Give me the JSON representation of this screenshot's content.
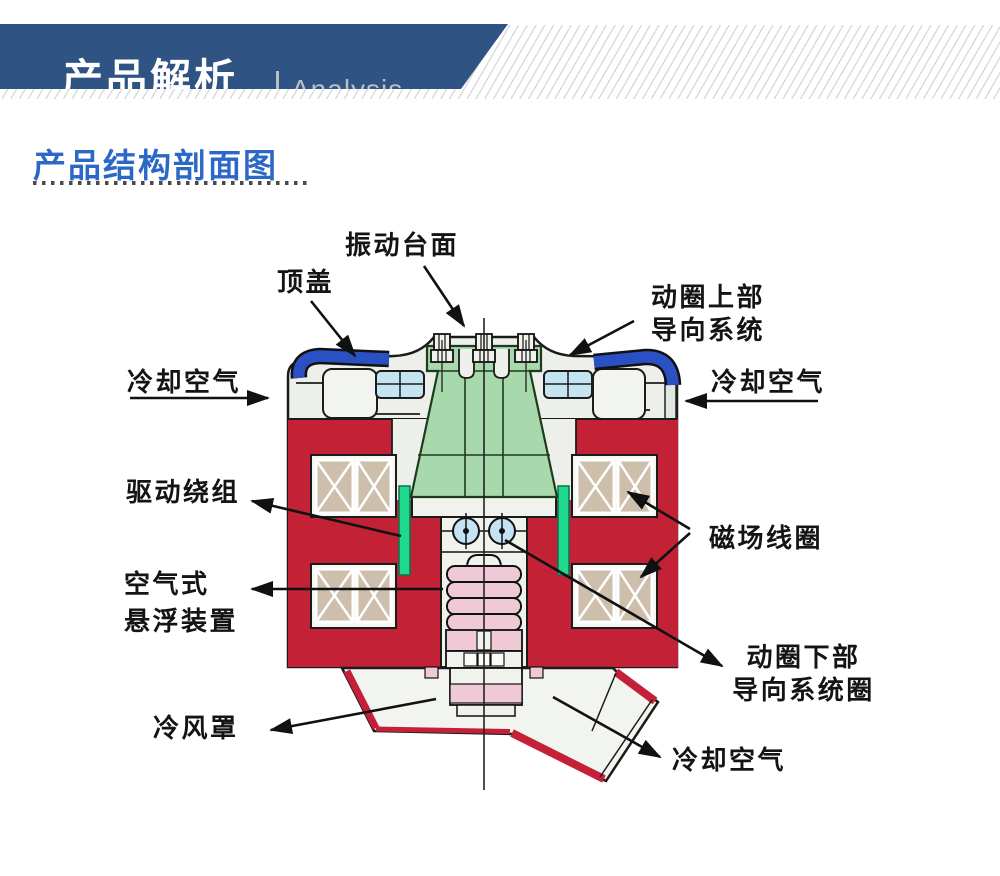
{
  "banner": {
    "title": "产品解析",
    "divider": "|",
    "subtitle": "Analysis"
  },
  "section": {
    "heading": "产品结构剖面图"
  },
  "labels": {
    "vibration_table": "振动台面",
    "top_cover": "顶盖",
    "upper_guide": "动圈上部\n导向系统",
    "cooling_air_left": "冷却空气",
    "cooling_air_right": "冷却空气",
    "drive_winding": "驱动绕组",
    "field_coil": "磁场线圈",
    "air_suspension": "空气式\n悬浮装置",
    "cold_hood": "冷风罩",
    "lower_guide": "动圈下部\n导向系统圈",
    "cooling_air_bottom": "冷却空气"
  },
  "colors": {
    "banner_blue": "#2f5382",
    "heading_blue": "#2b68c8",
    "cover_blue": "#2b50c4",
    "body_red": "#c32236",
    "hood_trim_red": "#c5203a",
    "armature_green": "#a8d9ac",
    "strip_green": "#1fd98f",
    "coil_tan": "#cdbfab",
    "bellows_pink": "#f0c9d6",
    "roller_blue": "#c5e2f3",
    "cyan_box": "#c3e4f0",
    "body_white": "#edf0ea",
    "outline_black": "#1b1b1b"
  }
}
